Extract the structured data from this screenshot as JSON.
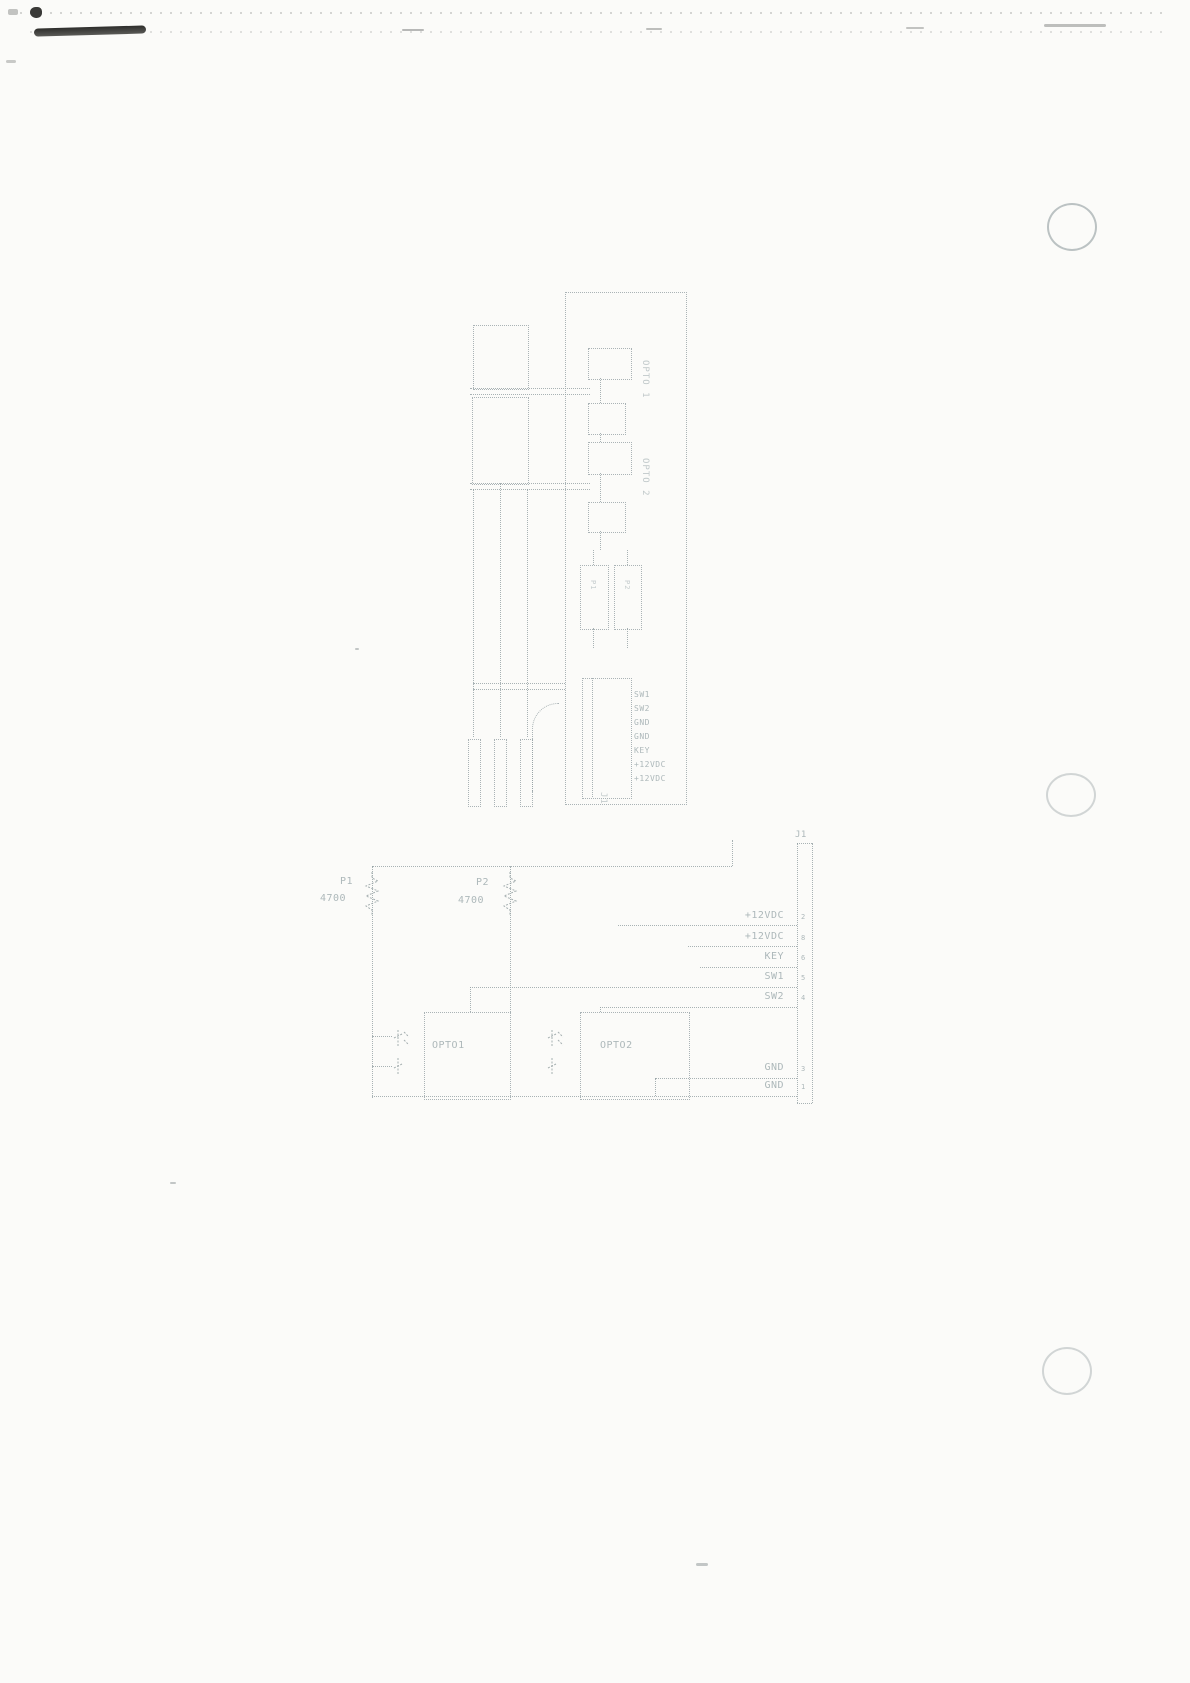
{
  "page": {
    "background": "#fbfbf9",
    "ink_color": "#aab4b6",
    "artifact_dark_color": "#2d2d2b",
    "description_colors": {
      "hole_punch_ring": "#a8b0b2"
    }
  },
  "upper_diagram": {
    "opto_labels": [
      "OPTO 1",
      "OPTO 2"
    ],
    "resistor_labels": [
      "P1",
      "P2"
    ],
    "connector": {
      "name": "J1",
      "pin_labels": [
        "SW1",
        "SW2",
        "GND",
        "GND",
        "KEY",
        "+12VDC",
        "+12VDC"
      ]
    }
  },
  "lower_diagram": {
    "resistors": [
      {
        "ref": "P1",
        "value": "4700"
      },
      {
        "ref": "P2",
        "value": "4700"
      }
    ],
    "optocouplers": [
      {
        "label": "OPTO1"
      },
      {
        "label": "OPTO2"
      }
    ],
    "connector": {
      "name": "J1",
      "pins": [
        {
          "label": "+12VDC",
          "number": "2"
        },
        {
          "label": "+12VDC",
          "number": "8"
        },
        {
          "label": "KEY",
          "number": "6"
        },
        {
          "label": "SW1",
          "number": "5"
        },
        {
          "label": "SW2",
          "number": "4"
        },
        {
          "label": "GND",
          "number": "3"
        },
        {
          "label": "GND",
          "number": "1"
        }
      ]
    }
  }
}
